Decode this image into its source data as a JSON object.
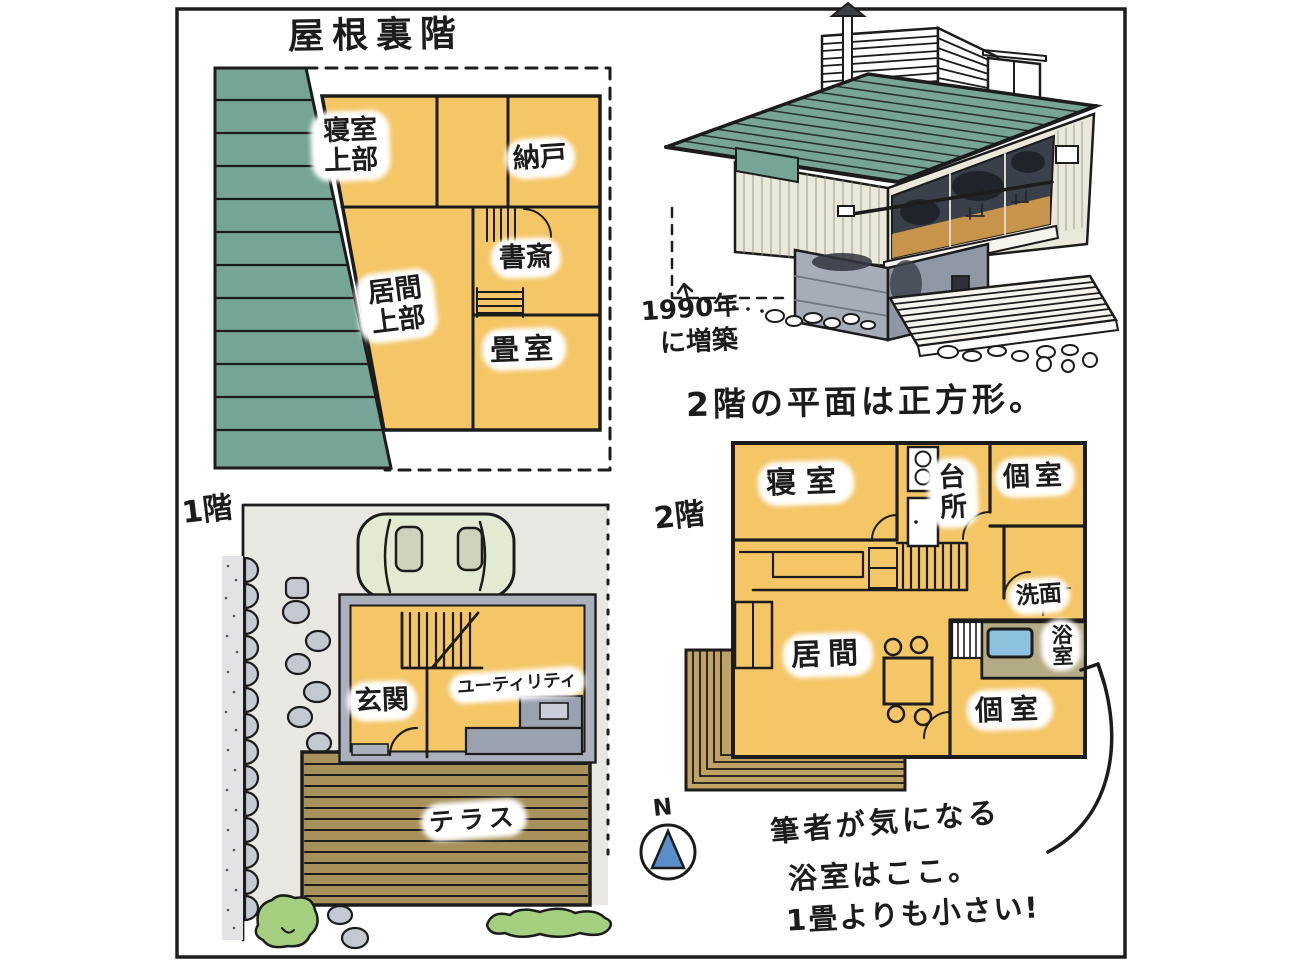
{
  "palette": {
    "ink": "#1c1c1c",
    "room_yellow": "#f4c666",
    "roof_teal": "#76a597",
    "terrace_brown": "#a8915a",
    "balcony_brown": "#c0a265",
    "tub_blue": "#8cc1e0",
    "bush_green": "#a3cf7e",
    "stone_gray": "#c3c8d1",
    "concrete_gray": "#9aa2b0",
    "compass_blue": "#5b8fc9"
  },
  "attic": {
    "title": "屋根裏階",
    "rooms": [
      {
        "label": "寝室上部"
      },
      {
        "label": "納戸"
      },
      {
        "label": "書斎"
      },
      {
        "label": "畳室"
      },
      {
        "label": "居間上部"
      }
    ]
  },
  "house_illustration": {
    "annotation_lines": [
      "1990年",
      "に増築"
    ]
  },
  "second_floor": {
    "headline": "2階の平面は正方形。",
    "label": "2階",
    "rooms": [
      {
        "label": "寝室"
      },
      {
        "label": "台所"
      },
      {
        "label": "個室"
      },
      {
        "label": "洗面"
      },
      {
        "label": "浴室"
      },
      {
        "label": "個室"
      },
      {
        "label": "居間"
      }
    ]
  },
  "first_floor": {
    "label": "1階",
    "rooms": [
      {
        "label": "玄関"
      },
      {
        "label": "ユーティリティ"
      },
      {
        "label": "テラス"
      }
    ]
  },
  "compass": {
    "label": "N"
  },
  "note": {
    "lines": [
      "筆者が気になる",
      "浴室はここ。",
      "1畳よりも小さい!"
    ]
  }
}
